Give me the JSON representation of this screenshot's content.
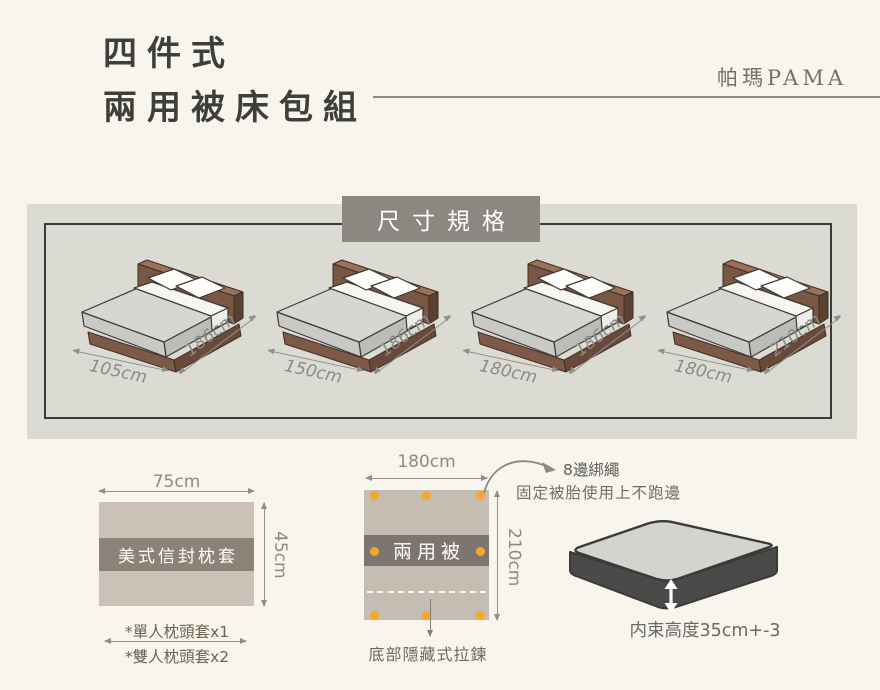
{
  "header": {
    "title_line1": "四件式",
    "title_line2": "兩用被床包組",
    "brand": "帕瑪PAMA"
  },
  "size_section": {
    "heading": "尺寸規格",
    "beds": [
      {
        "width": "105cm",
        "length": "186cm"
      },
      {
        "width": "150cm",
        "length": "186cm"
      },
      {
        "width": "180cm",
        "length": "186cm"
      },
      {
        "width": "180cm",
        "length": "210cm"
      }
    ]
  },
  "pillow": {
    "width_label": "75cm",
    "height_label": "45cm",
    "name": "美式信封枕套",
    "note1": "*單人枕頭套x1",
    "note2": "*雙人枕頭套x2"
  },
  "quilt": {
    "width_label": "180cm",
    "height_label": "210cm",
    "name": "兩用被",
    "tie_label": "8邊綁繩",
    "tie_note": "固定被胎使用上不跑邊",
    "zipper_note": "底部隱藏式拉鍊"
  },
  "mattress": {
    "height_note": "内束高度35cm+-3"
  },
  "colors": {
    "background": "#f7f5ec",
    "panel": "#dcdbd3",
    "heading_box": "#8d8781",
    "pillow_fabric": "#cbc1b6",
    "pillow_band": "#8d8278",
    "quilt_fabric": "#c6bdb2",
    "quilt_band": "#7b7670",
    "tie_dot": "#f6a62b",
    "bed_wood": "#7a5644",
    "mattress_top": "#d6d6d3",
    "mattress_skirt": "#4b4a48"
  }
}
